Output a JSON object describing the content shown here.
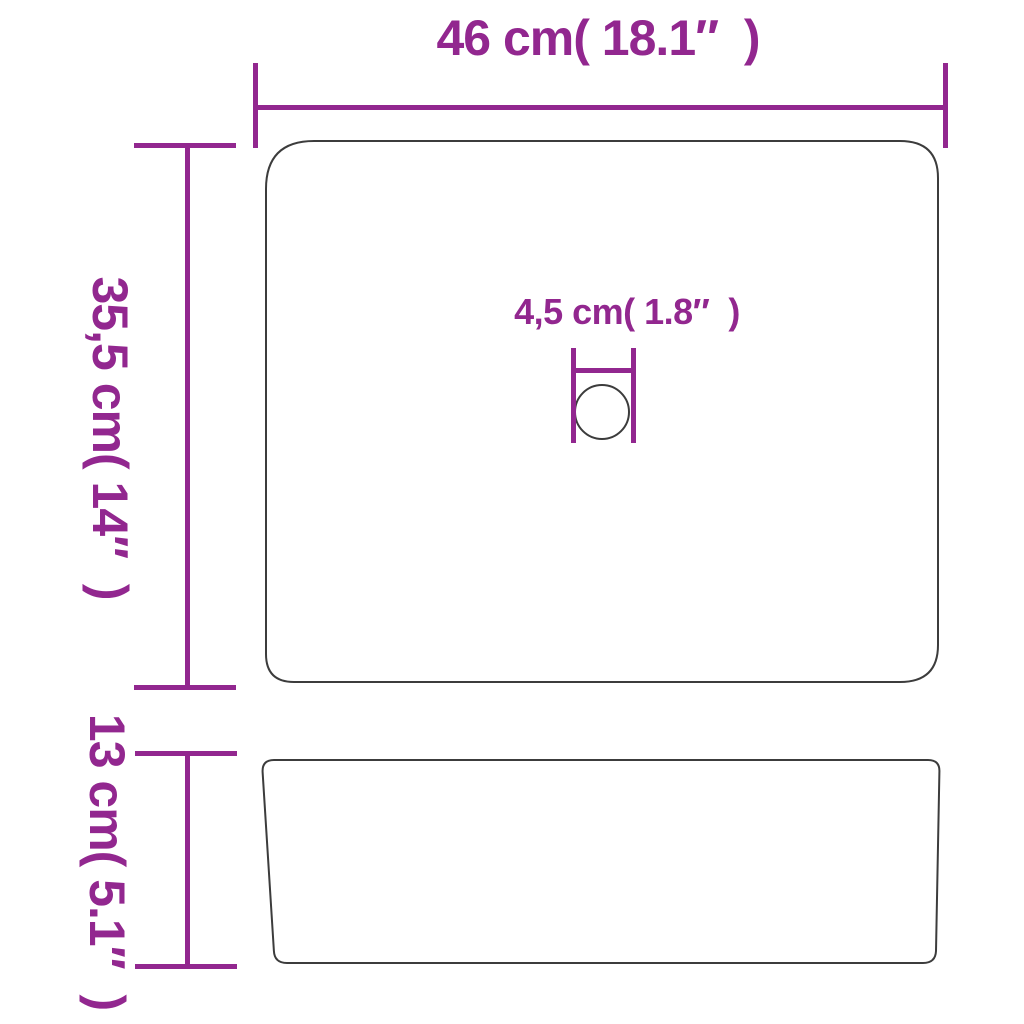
{
  "diagram": {
    "labels": {
      "overall_width": "46 cm( 18.1″  )",
      "overall_depth": "35,5 cm( 14″  )",
      "drain_diameter": "4,5 cm( 1.8″  )",
      "overall_height": "13 cm( 5.1″  )"
    },
    "colors": {
      "dimension_accent": "#92278f",
      "outline": "#3c3c3c",
      "background": "#ffffff"
    }
  }
}
